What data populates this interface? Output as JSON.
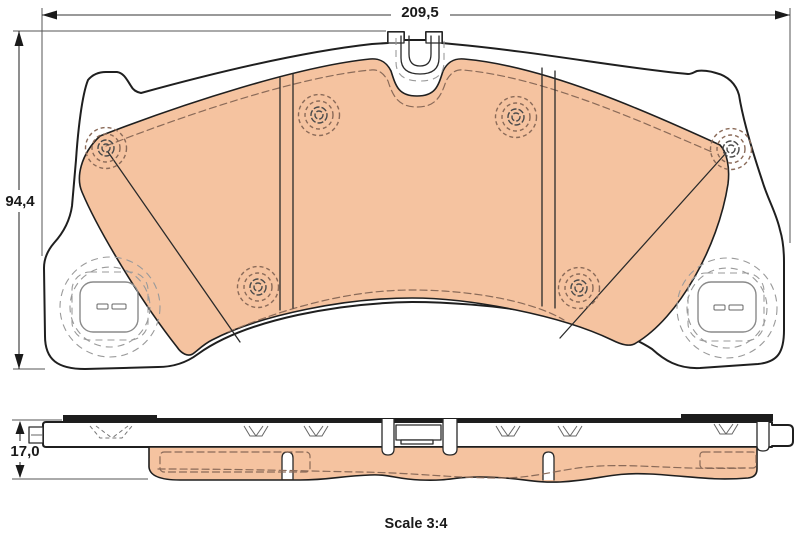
{
  "labels": {
    "width": "209,5",
    "height": "94,4",
    "thickness": "17,0",
    "scale": "Scale 3:4"
  },
  "colors": {
    "background": "#ffffff",
    "friction_material": "#f5c3a0",
    "outline": "#1f1f1f",
    "hidden_detail": "#8a6a58",
    "lug_detail": "#9a9a9a",
    "dimension_text": "#1a1a1a",
    "shim_bar": "#1d1d1d"
  }
}
